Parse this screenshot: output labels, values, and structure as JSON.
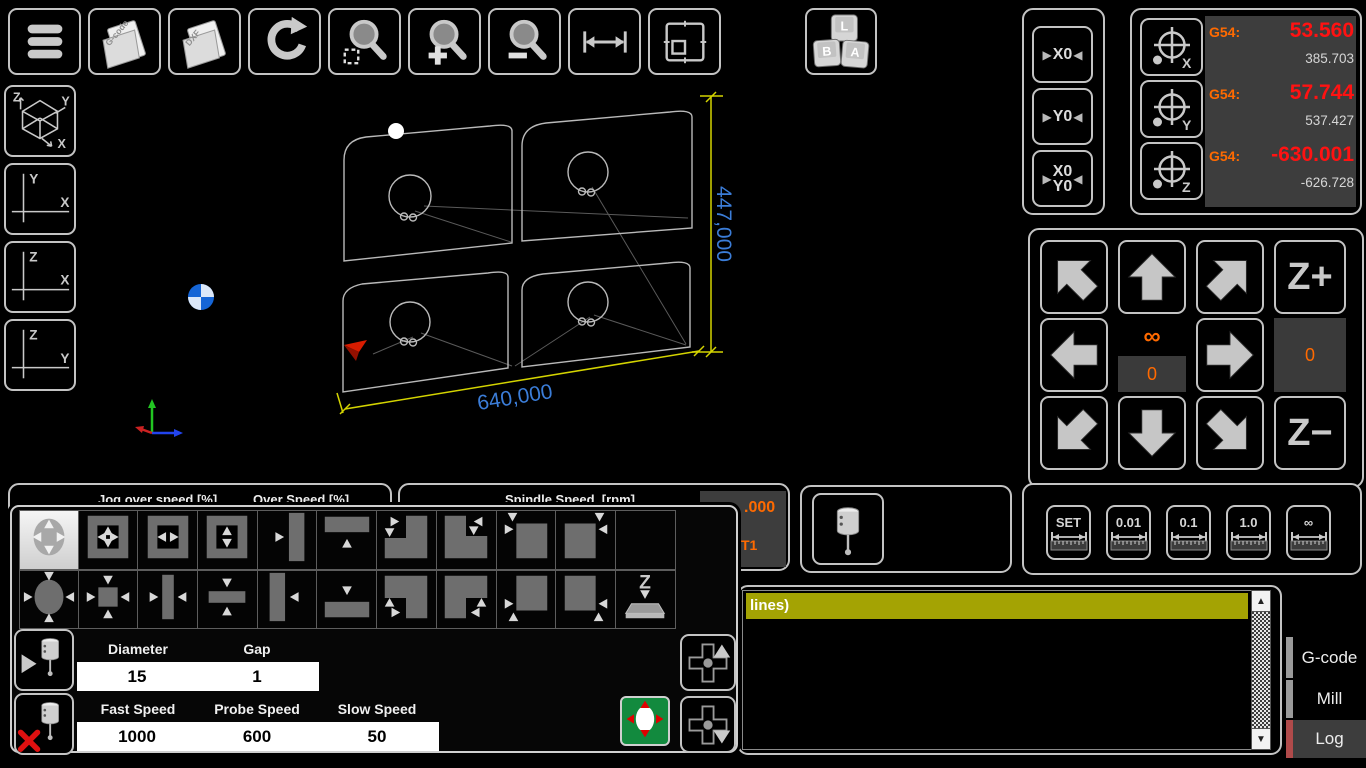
{
  "colors": {
    "accent_orange": "#ff6a00",
    "value_red": "#ff1212",
    "machine_gray": "#d6d6d6",
    "dim_blue": "#3b7dd8",
    "dim_yellow": "#d4d400",
    "log_highlight": "#a4a303",
    "log_tab_accent": "#b04a4a",
    "tab_accent_gray": "#9a9a9a",
    "probe_green": "#128a3e"
  },
  "toolbar": {
    "buttons": [
      {
        "name": "menu-button",
        "icon": "menu-icon"
      },
      {
        "name": "open-gcode-button",
        "icon": "folder-gcode-icon",
        "label": "G-code"
      },
      {
        "name": "open-dxf-button",
        "icon": "folder-dxf-icon",
        "label": "DXF"
      },
      {
        "name": "refresh-button",
        "icon": "refresh-icon"
      },
      {
        "name": "zoom-window-button",
        "icon": "zoom-window-icon"
      },
      {
        "name": "zoom-in-button",
        "icon": "zoom-in-icon"
      },
      {
        "name": "zoom-out-button",
        "icon": "zoom-out-icon"
      },
      {
        "name": "measure-button",
        "icon": "measure-icon"
      },
      {
        "name": "fit-view-button",
        "icon": "fit-view-icon"
      }
    ]
  },
  "keyboard_button": {
    "keys": [
      "L",
      "B",
      "A"
    ]
  },
  "view_buttons": [
    {
      "name": "view-iso-button",
      "type": "iso",
      "labels": [
        "Z",
        "Y",
        "X"
      ]
    },
    {
      "name": "view-top-button",
      "type": "plane",
      "labels": [
        "Y",
        "X"
      ]
    },
    {
      "name": "view-front-button",
      "type": "plane",
      "labels": [
        "Z",
        "X"
      ]
    },
    {
      "name": "view-side-button",
      "type": "plane",
      "labels": [
        "Z",
        "Y"
      ]
    }
  ],
  "viewport": {
    "dim_width": "640,000",
    "dim_height": "447,000"
  },
  "zero_panel": {
    "marker_left": "▶",
    "marker_right": "◀",
    "buttons": [
      {
        "name": "zero-x-button",
        "lines": [
          "X0"
        ]
      },
      {
        "name": "zero-y-button",
        "lines": [
          "Y0"
        ]
      },
      {
        "name": "zero-xy-button",
        "lines": [
          "X0",
          "Y0"
        ]
      }
    ]
  },
  "g54_panel": {
    "rows": [
      {
        "axis": "X",
        "label": "G54:",
        "work": "53.560",
        "machine": "385.703"
      },
      {
        "axis": "Y",
        "label": "G54:",
        "work": "57.744",
        "machine": "537.427"
      },
      {
        "axis": "Z",
        "label": "G54:",
        "work": "-630.001",
        "machine": "-626.728"
      }
    ]
  },
  "jog_panel": {
    "z_plus": "Z+",
    "z_minus": "Z−",
    "infinity": "∞",
    "xy_step": "0",
    "z_step": "0"
  },
  "step_panel": {
    "buttons": [
      "SET",
      "0.01",
      "0.1",
      "1.0",
      "∞"
    ]
  },
  "speed_panels": {
    "jog_over_label": "Jog over speed [%]",
    "over_label": "Over Speed [%]",
    "spindle_label": "Spindle Speed  [rpm]",
    "tool_offset": ".000",
    "tool_number": "T1"
  },
  "probe_popup": {
    "patterns_row1": [
      "hole-4way",
      "pocket-4way",
      "pocket-x",
      "pocket-y",
      "edge-right",
      "edge-top",
      "corner-in-tl",
      "corner-in-tr",
      "corner-out-tl",
      "corner-out-tr",
      "empty"
    ],
    "patterns_row2": [
      "boss-4way",
      "boss-square",
      "boss-x",
      "boss-y",
      "edge-left",
      "edge-bottom",
      "corner-in-bl",
      "corner-in-br",
      "corner-out-bl",
      "corner-out-br",
      "z-plate"
    ],
    "selected_pattern": "hole-4way",
    "diameter_label": "Diameter",
    "diameter_value": "15",
    "gap_label": "Gap",
    "gap_value": "1",
    "fast_label": "Fast Speed",
    "fast_value": "1000",
    "probe_label": "Probe Speed",
    "probe_value": "600",
    "slow_label": "Slow Speed",
    "slow_value": "50"
  },
  "log_panel": {
    "first_line": "lines)",
    "tabs": [
      {
        "label": "G-code",
        "active": false
      },
      {
        "label": "Mill",
        "active": false
      },
      {
        "label": "Log",
        "active": true
      }
    ]
  }
}
